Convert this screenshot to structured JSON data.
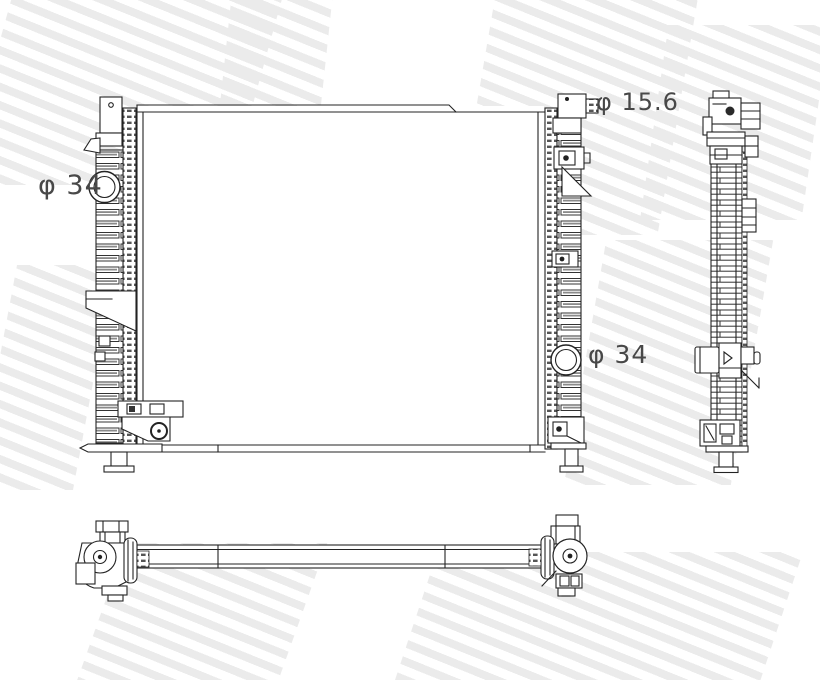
{
  "drawing": {
    "kind": "radiator technical line drawing",
    "views": {
      "front": {
        "name": "front view"
      },
      "side": {
        "name": "side profile view"
      },
      "plan": {
        "name": "bottom plan view"
      }
    },
    "dimension_labels": [
      {
        "id": "port-left",
        "text": "φ 34"
      },
      {
        "id": "inlet-top-right",
        "text": "φ 15.6"
      },
      {
        "id": "port-right",
        "text": "φ 34"
      }
    ],
    "colors": {
      "line": "#222222",
      "label": "#484848",
      "watermark_stripe": "#ebebeb",
      "background": "#ffffff"
    }
  }
}
